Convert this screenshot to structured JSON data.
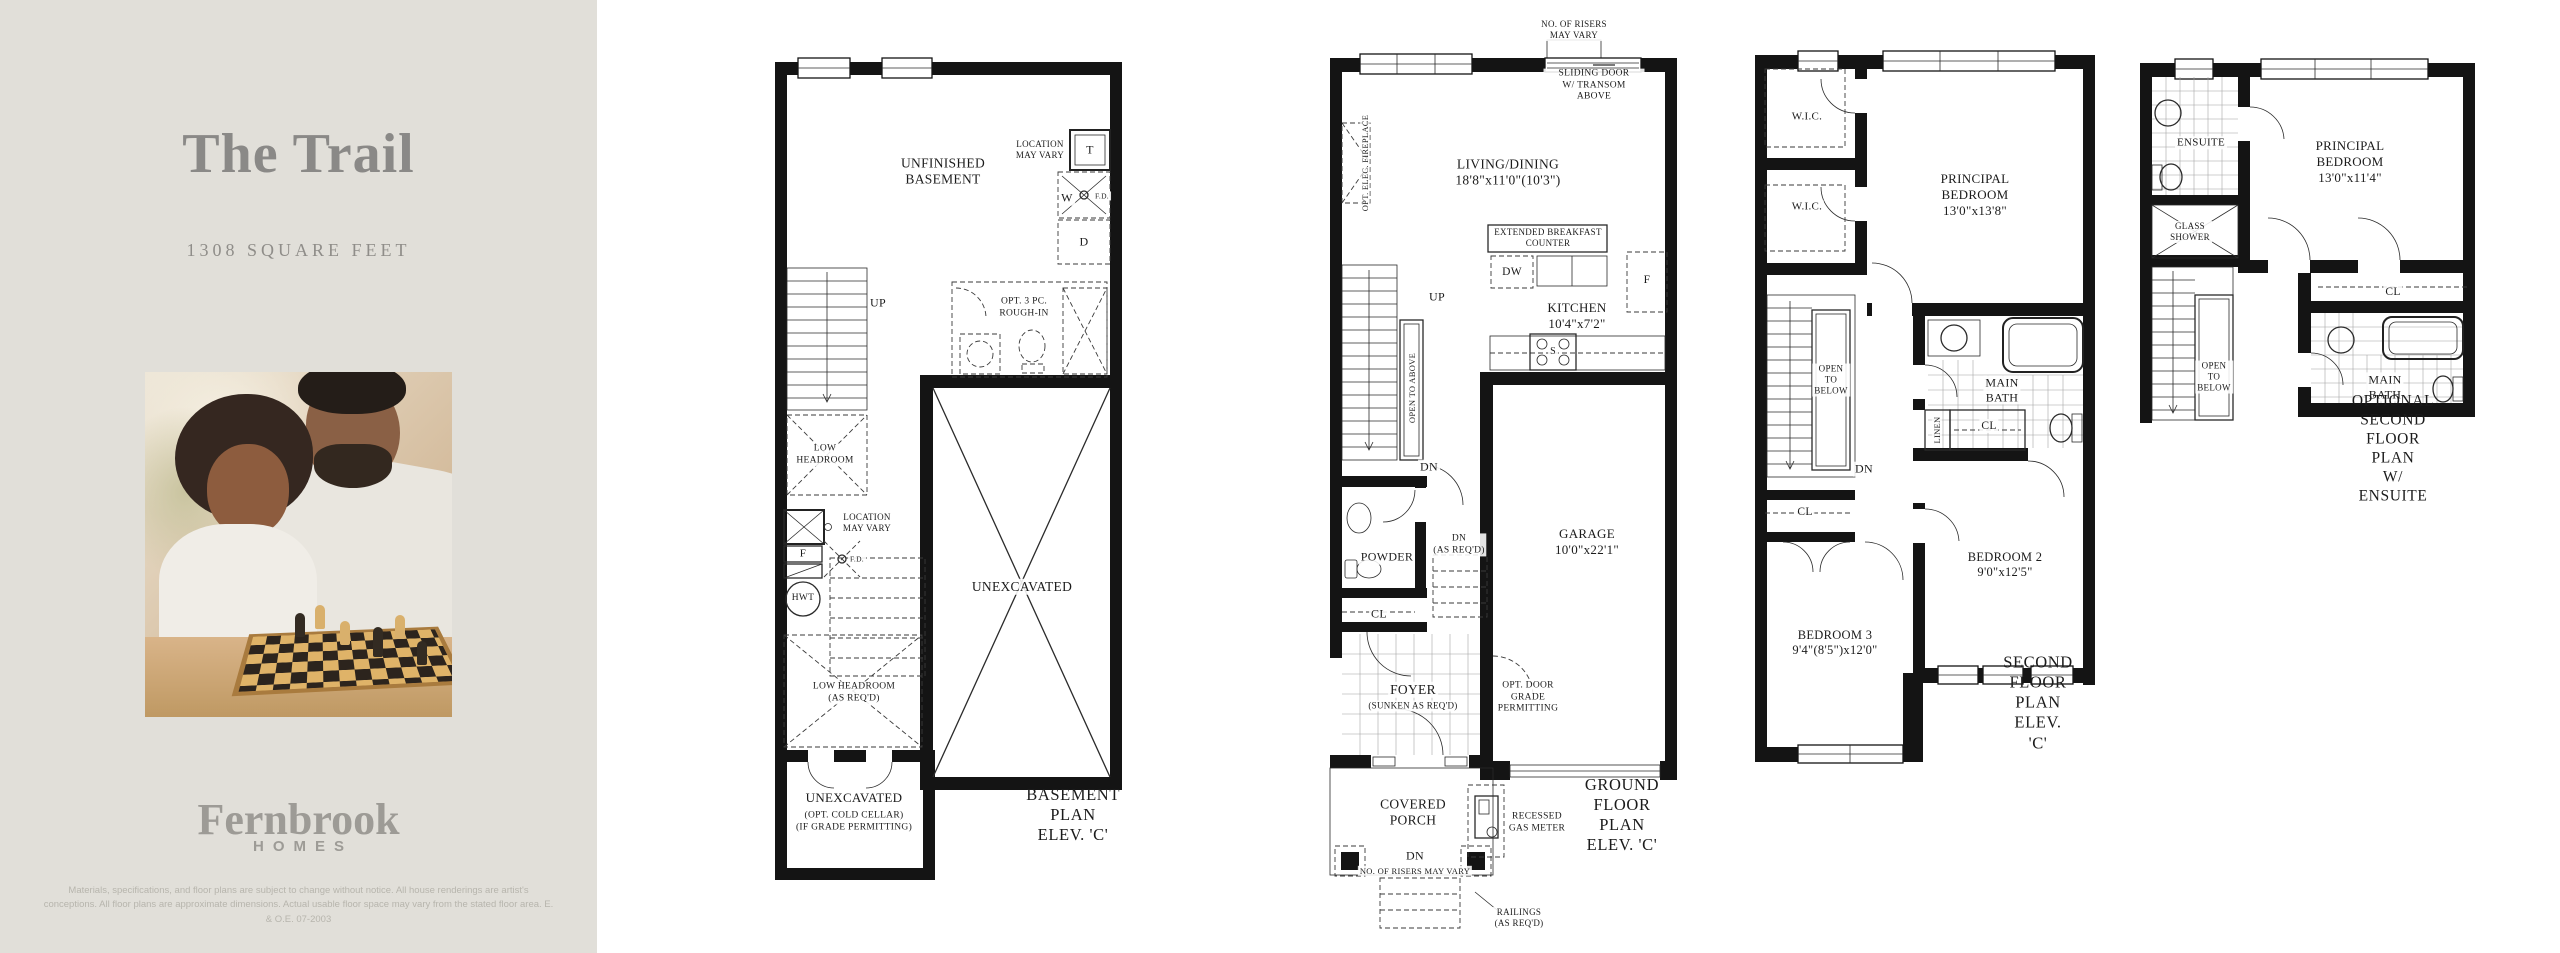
{
  "sidebar": {
    "title": "The Trail",
    "subtitle": "1308 SQUARE FEET",
    "logo_name": "Fernbrook",
    "logo_sub": "HOMES",
    "disclaimer": "Materials, specifications, and floor plans are subject to change without notice. All house renderings are artist's conceptions. All floor plans are approximate dimensions. Actual usable floor space may vary from the stated floor area. E. & O.E. 07-2003"
  },
  "colors": {
    "sidebar_bg": "#e1dfd9",
    "page_bg": "#ffffff",
    "plan_line": "#141414",
    "muted_text": "#8a8987"
  },
  "plans": {
    "basement": {
      "name": "Basement Plan",
      "labels": [
        {
          "t": "UNFINISHED\nBASEMENT",
          "x": 173,
          "y": 122,
          "s": 13.5
        },
        {
          "t": "LOCATION\nMAY VARY",
          "x": 270,
          "y": 100,
          "s": 9
        },
        {
          "t": "T",
          "x": 320,
          "y": 100,
          "s": 12
        },
        {
          "t": "W",
          "x": 297,
          "y": 148,
          "s": 12
        },
        {
          "t": "F.D.",
          "x": 332,
          "y": 146,
          "s": 7.5
        },
        {
          "t": "D",
          "x": 314,
          "y": 192,
          "s": 12
        },
        {
          "t": "UP",
          "x": 108,
          "y": 253,
          "s": 12
        },
        {
          "t": "OPT. 3 PC.\nROUGH-IN",
          "x": 254,
          "y": 258,
          "s": 9.5
        },
        {
          "t": "LOW\nHEADROOM",
          "x": 55,
          "y": 405,
          "s": 9.5
        },
        {
          "t": "LOCATION\nMAY VARY",
          "x": 97,
          "y": 473,
          "s": 9
        },
        {
          "t": "F",
          "x": 33,
          "y": 504,
          "s": 11
        },
        {
          "t": "F.D.",
          "x": 87,
          "y": 509,
          "s": 7.5
        },
        {
          "t": "HWT",
          "x": 33,
          "y": 549,
          "s": 9.5
        },
        {
          "t": "UNEXCAVATED",
          "x": 252,
          "y": 537,
          "s": 13.5
        },
        {
          "t": "LOW HEADROOM\n(AS REQ'D)",
          "x": 84,
          "y": 643,
          "s": 9.5
        },
        {
          "t": "UNEXCAVATED",
          "x": 84,
          "y": 748,
          "s": 13
        },
        {
          "t": "(OPT. COLD CELLAR)\n(IF GRADE PERMITTING)",
          "x": 84,
          "y": 772,
          "s": 9.5
        },
        {
          "t": "BASEMENT PLAN\nELEV. 'C'",
          "x": 303,
          "y": 765,
          "s": 16.5,
          "c": "cap",
          "n": "basement-plan-caption"
        }
      ]
    },
    "ground": {
      "name": "Ground Floor Plan",
      "labels": [
        {
          "t": "NO. OF RISERS\nMAY VARY",
          "x": 249,
          "y": 10,
          "s": 9
        },
        {
          "t": "SLIDING DOOR\nW/ TRANSOM ABOVE",
          "x": 269,
          "y": 66,
          "s": 9.5
        },
        {
          "t": "OPT. ELEC. FIREPLACE",
          "x": 40,
          "y": 143,
          "s": 8.5,
          "v": true
        },
        {
          "t": "LIVING/DINING\n18'8\"x11'0\"(10'3\")",
          "x": 183,
          "y": 153,
          "s": 13.5
        },
        {
          "t": "EXTENDED BREAKFAST\nCOUNTER",
          "x": 223,
          "y": 218,
          "s": 9
        },
        {
          "t": "DW",
          "x": 187,
          "y": 252,
          "s": 11.5
        },
        {
          "t": "F",
          "x": 322,
          "y": 260,
          "s": 11.5
        },
        {
          "t": "UP",
          "x": 112,
          "y": 277,
          "s": 12
        },
        {
          "t": "KITCHEN\n10'4\"x7'2\"",
          "x": 252,
          "y": 296,
          "s": 13
        },
        {
          "t": "S",
          "x": 228,
          "y": 332,
          "s": 10
        },
        {
          "t": "OPEN TO ABOVE",
          "x": 87,
          "y": 368,
          "s": 8.5,
          "v": true
        },
        {
          "t": "DN",
          "x": 104,
          "y": 447,
          "s": 12
        },
        {
          "t": "DN\n(AS REQ'D)",
          "x": 134,
          "y": 525,
          "s": 9.5
        },
        {
          "t": "POWDER",
          "x": 62,
          "y": 537,
          "s": 12
        },
        {
          "t": "GARAGE\n10'0\"x22'1\"",
          "x": 262,
          "y": 522,
          "s": 13
        },
        {
          "t": "CL",
          "x": 54,
          "y": 594,
          "s": 12
        },
        {
          "t": "FOYER",
          "x": 88,
          "y": 670,
          "s": 13.5
        },
        {
          "t": "(SUNKEN AS REQ'D)",
          "x": 88,
          "y": 686,
          "s": 9
        },
        {
          "t": "OPT. DOOR\nGRADE\nPERMITTING",
          "x": 203,
          "y": 678,
          "s": 9.5
        },
        {
          "t": "COVERED\nPORCH",
          "x": 88,
          "y": 793,
          "s": 13.5
        },
        {
          "t": "RECESSED\nGAS METER",
          "x": 212,
          "y": 803,
          "s": 9.5
        },
        {
          "t": "GROUND FLOOR PLAN\nELEV. 'C'",
          "x": 297,
          "y": 795,
          "s": 16.5,
          "c": "cap",
          "n": "ground-floor-plan-caption"
        },
        {
          "t": "DN",
          "x": 90,
          "y": 836,
          "s": 12
        },
        {
          "t": "NO. OF RISERS MAY VARY",
          "x": 90,
          "y": 851,
          "s": 8.5
        },
        {
          "t": "RAILINGS\n(AS REQ'D)",
          "x": 194,
          "y": 898,
          "s": 9
        },
        {
          "t": "S",
          "x": 228,
          "y": 332,
          "s": 0.1,
          "n": "stove-marker"
        }
      ]
    },
    "second": {
      "name": "Second Floor Plan",
      "labels": [
        {
          "t": "W.I.C.",
          "x": 57,
          "y": 72,
          "s": 11
        },
        {
          "t": "W.I.C.",
          "x": 57,
          "y": 162,
          "s": 11
        },
        {
          "t": "PRINCIPAL BEDROOM\n13'0\"x13'8\"",
          "x": 225,
          "y": 150,
          "s": 13
        },
        {
          "t": "OPEN\nTO\nBELOW",
          "x": 81,
          "y": 335,
          "s": 9
        },
        {
          "t": "DN",
          "x": 114,
          "y": 424,
          "s": 12
        },
        {
          "t": "MAIN\nBATH",
          "x": 252,
          "y": 345,
          "s": 12
        },
        {
          "t": "LINEN",
          "x": 187,
          "y": 385,
          "s": 8.5,
          "v": true
        },
        {
          "t": "CL",
          "x": 239,
          "y": 381,
          "s": 11.5
        },
        {
          "t": "CL",
          "x": 55,
          "y": 467,
          "s": 11.5
        },
        {
          "t": "BEDROOM 3\n9'4\"(8'5\")x12'0\"",
          "x": 85,
          "y": 598,
          "s": 12.5
        },
        {
          "t": "BEDROOM 2\n9'0\"x12'5\"",
          "x": 255,
          "y": 520,
          "s": 12.5
        },
        {
          "t": "SECOND FLOOR PLAN\nELEV. 'C'",
          "x": 288,
          "y": 658,
          "s": 16.5,
          "c": "cap",
          "n": "second-floor-plan-caption"
        }
      ]
    },
    "optional": {
      "name": "Optional Second Floor Plan",
      "labels": [
        {
          "t": "ENSUITE",
          "x": 66,
          "y": 88,
          "s": 11
        },
        {
          "t": "GLASS\nSHOWER",
          "x": 55,
          "y": 177,
          "s": 9
        },
        {
          "t": "PRINCIPAL BEDROOM\n13'0\"x11'4\"",
          "x": 215,
          "y": 107,
          "s": 13
        },
        {
          "t": "OPEN\nTO\nBELOW",
          "x": 79,
          "y": 322,
          "s": 9
        },
        {
          "t": "CL",
          "x": 258,
          "y": 237,
          "s": 11.5
        },
        {
          "t": "MAIN\nBATH",
          "x": 250,
          "y": 332,
          "s": 12
        },
        {
          "t": "OPTIONAL SECOND FLOOR PLAN\nW/ ENSUITE",
          "x": 258,
          "y": 394,
          "s": 15.5,
          "c": "cap",
          "n": "optional-plan-caption"
        }
      ]
    }
  }
}
